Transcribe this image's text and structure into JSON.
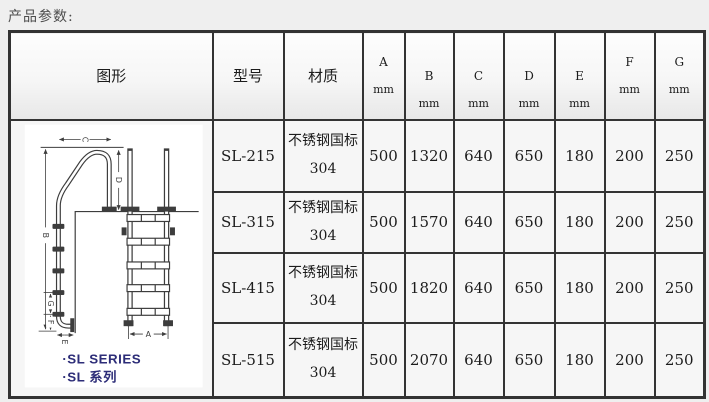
{
  "page": {
    "title": "产品参数:"
  },
  "table": {
    "headers": {
      "figure": "图形",
      "model": "型号",
      "material": "材质"
    },
    "dim_columns": [
      {
        "letter": "A",
        "unit": "mm"
      },
      {
        "letter": "B",
        "unit": "mm"
      },
      {
        "letter": "C",
        "unit": "mm"
      },
      {
        "letter": "D",
        "unit": "mm"
      },
      {
        "letter": "E",
        "unit": "mm"
      },
      {
        "letter": "F",
        "unit": "mm"
      },
      {
        "letter": "G",
        "unit": "mm"
      }
    ],
    "rows": [
      {
        "model": "SL-215",
        "material": {
          "line1": "不锈钢国标",
          "line2": "304"
        },
        "values": [
          "500",
          "1320",
          "640",
          "650",
          "180",
          "200",
          "250"
        ]
      },
      {
        "model": "SL-315",
        "material": {
          "line1": "不锈钢国标",
          "line2": "304"
        },
        "values": [
          "500",
          "1570",
          "640",
          "650",
          "180",
          "200",
          "250"
        ]
      },
      {
        "model": "SL-415",
        "material": {
          "line1": "不锈钢国标",
          "line2": "304"
        },
        "values": [
          "500",
          "1820",
          "640",
          "650",
          "180",
          "200",
          "250"
        ]
      },
      {
        "model": "SL-515",
        "material": {
          "line1": "不锈钢国标",
          "line2": "304"
        },
        "values": [
          "500",
          "2070",
          "640",
          "650",
          "180",
          "200",
          "250"
        ]
      }
    ]
  },
  "figure": {
    "dimension_labels": {
      "a": "A",
      "b": "B",
      "c": "C",
      "d": "D",
      "e": "E",
      "f": "F",
      "g": "G"
    },
    "caption_en": "·SL SERIES",
    "caption_cn": "·SL 系列"
  },
  "colors": {
    "page_bg": "#efefef",
    "cell_bg": "#f6f6f6",
    "grid": "#333333",
    "caption": "#2d2d78",
    "text": "#1c1c1c",
    "title": "#4d4d4d"
  }
}
